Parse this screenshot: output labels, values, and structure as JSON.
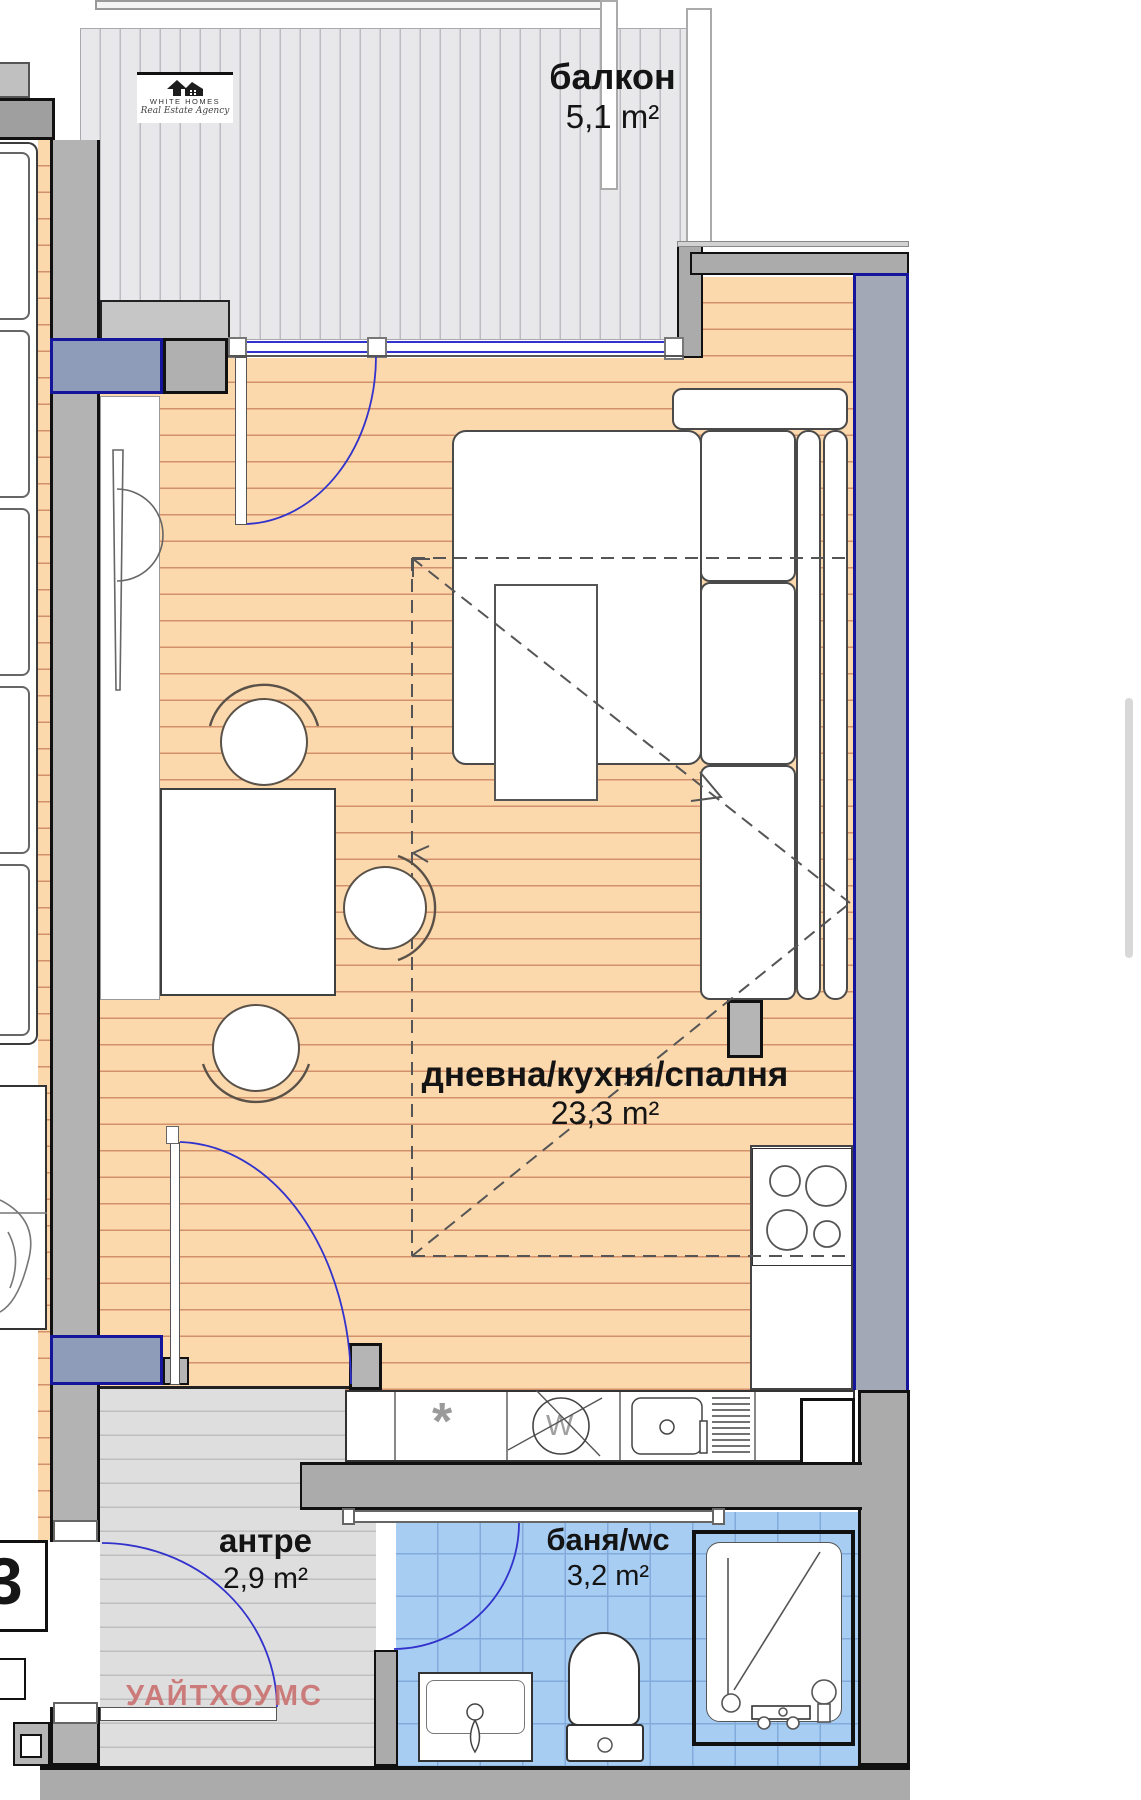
{
  "logo": {
    "name": "WHITE HOMES",
    "tagline": "Real Estate Agency"
  },
  "rooms": [
    {
      "name": "балкон",
      "area": "5,1 m²"
    },
    {
      "name": "дневна/кухня/спалня",
      "area": "23,3 m²"
    },
    {
      "name": "антре",
      "area": "2,9 m²"
    },
    {
      "name": "баня/wc",
      "area": "3,2 m²"
    }
  ],
  "watermark": "УАЙТХОУМС",
  "neighbor_unit_label": "3",
  "symbols": {
    "washer": "W",
    "dishwasher": "*"
  },
  "colors": {
    "wall_outline": "#111111",
    "exterior_wall_accent": "#15159b",
    "window_blue": "#3232cc",
    "floor_wood": "#fcd8ad",
    "floor_bath": "#a8cdf2",
    "floor_balcony": "#e8e8ea",
    "floor_hall": "#dedede",
    "watermark_red": "#c76b6b"
  }
}
